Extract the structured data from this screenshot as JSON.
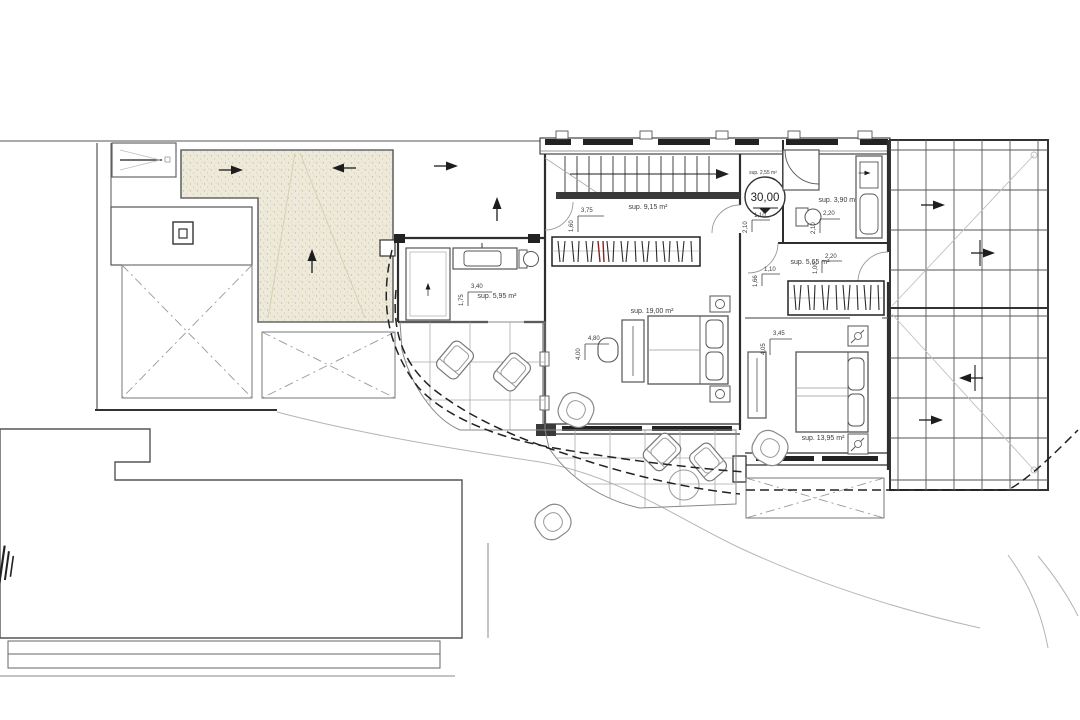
{
  "drawing": {
    "type": "architectural-floor-plan",
    "colors": {
      "paper": "#ffffff",
      "line": "#3a3a3a",
      "dark": "#222222",
      "light": "#b0b0b0",
      "sand": "#eeeadb",
      "sand_dot": "#c8c09c",
      "red_accent": "#8a2020"
    }
  },
  "level_marker": {
    "value": "30,00",
    "area_label": "sup. 2,55 m²"
  },
  "rooms": [
    {
      "name": "dressing",
      "area_label": "sup. 9,15 m²"
    },
    {
      "name": "master-bedroom",
      "area_label": "sup. 19,00 m²"
    },
    {
      "name": "bathroom-1",
      "area_label": "sup. 5,95 m²"
    },
    {
      "name": "bathroom-2",
      "area_label": "sup. 3,90 m²"
    },
    {
      "name": "hall",
      "area_label": "sup. 5,65 m²"
    },
    {
      "name": "bedroom-2",
      "area_label": "sup. 13,95 m²"
    }
  ],
  "dimensions": [
    {
      "id": "dressing-width",
      "value": "3,75"
    },
    {
      "id": "dressing-depth",
      "value": "1,60"
    },
    {
      "id": "bath1-width",
      "value": "3,40"
    },
    {
      "id": "bath1-depth",
      "value": "1,75"
    },
    {
      "id": "master-width",
      "value": "4,80"
    },
    {
      "id": "master-depth",
      "value": "4,00"
    },
    {
      "id": "bedroom2-width",
      "value": "3,45"
    },
    {
      "id": "bedroom2-depth",
      "value": "4,05"
    },
    {
      "id": "landing-width",
      "value": "1,10"
    },
    {
      "id": "landing-depth",
      "value": "2,10"
    },
    {
      "id": "bath2-width",
      "value": "2,20"
    },
    {
      "id": "bath2-depth",
      "value": "2,10"
    },
    {
      "id": "hall-width-a",
      "value": "1,10"
    },
    {
      "id": "hall-depth-a",
      "value": "1,66"
    },
    {
      "id": "hall-width-b",
      "value": "2,20"
    },
    {
      "id": "hall-depth-b",
      "value": "1,00"
    }
  ]
}
